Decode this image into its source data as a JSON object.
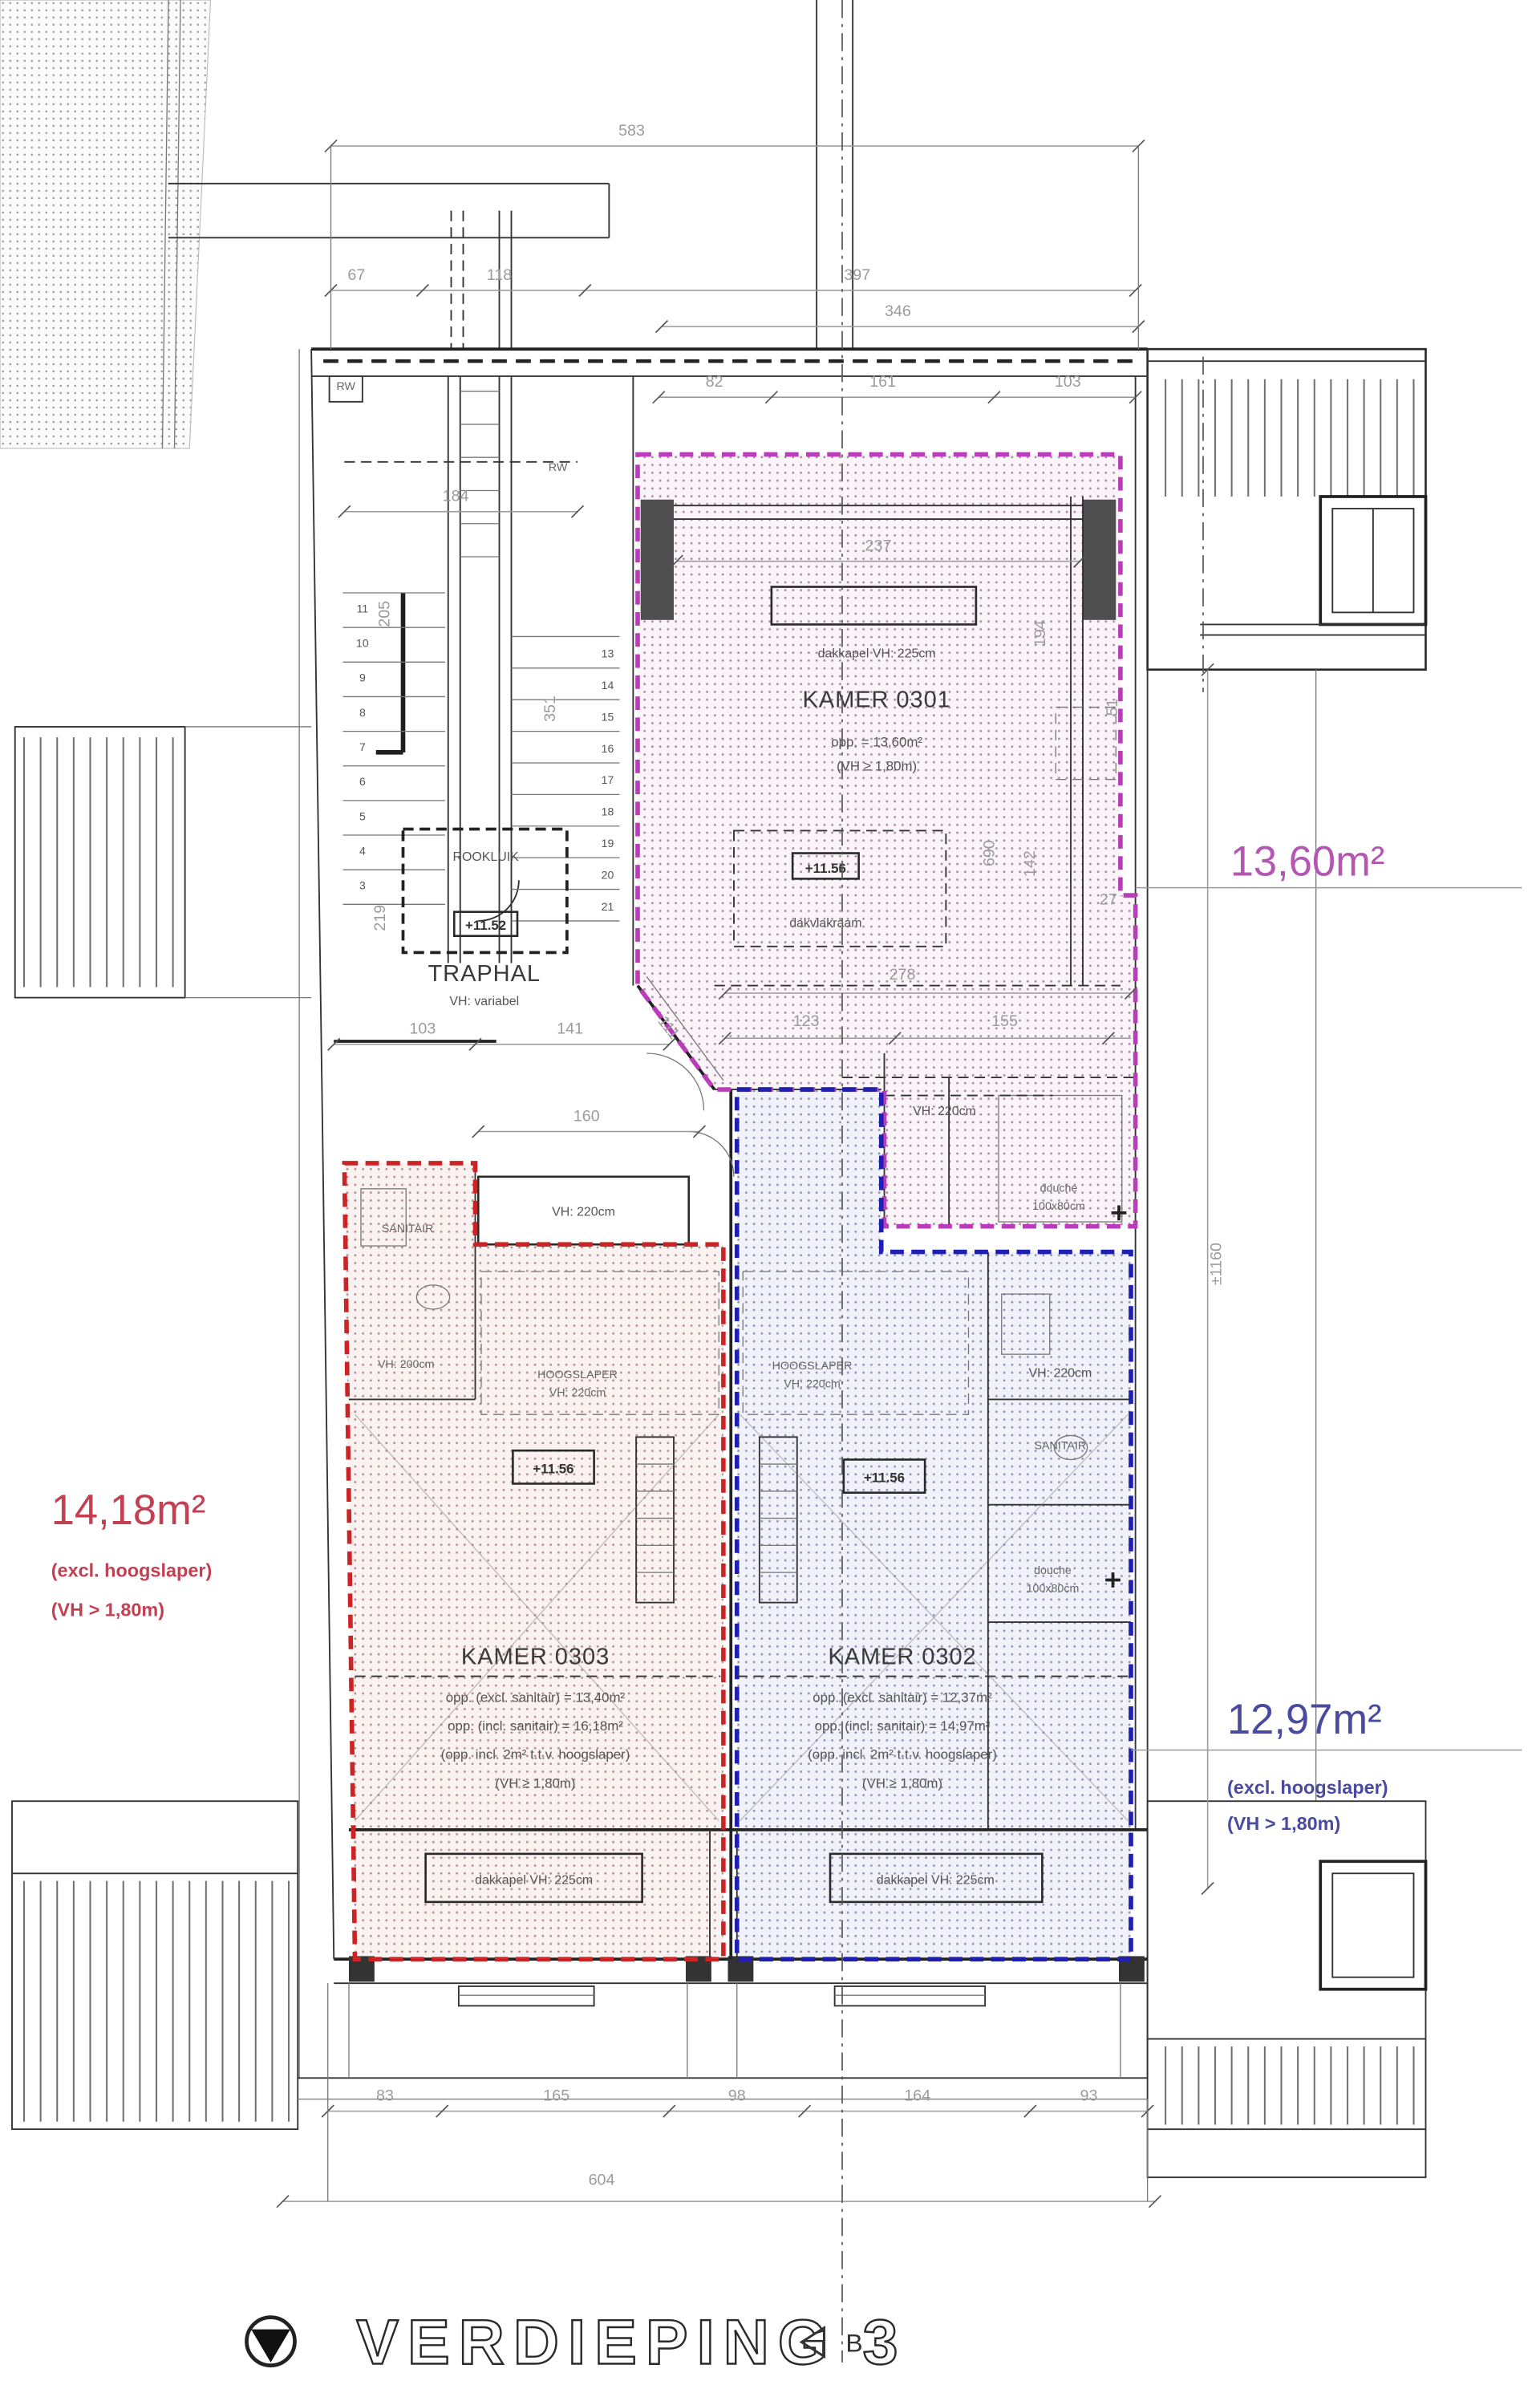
{
  "colors": {
    "magenta": "#b93cb9",
    "red": "#cc2424",
    "blue": "#2020b0",
    "callout_magenta": "#b357b3",
    "callout_red": "#c24052",
    "callout_blue": "#4a4aa0"
  },
  "title": {
    "floor_label": "VERDIEPING 3",
    "section_marker": "B"
  },
  "stairs": {
    "left": [
      "11",
      "10",
      "9",
      "8",
      "7",
      "6",
      "5",
      "4",
      "3"
    ],
    "right": [
      "13",
      "14",
      "15",
      "16",
      "17",
      "18",
      "19",
      "20",
      "21"
    ]
  },
  "traphal": {
    "name": "TRAPHAL",
    "vh": "VH: variabel",
    "rookluik": "ROOKLUIK",
    "level": "+11.52",
    "landing_vh": "VH: 220cm"
  },
  "kamer0301": {
    "name": "KAMER 0301",
    "dakkapel": "dakkapel VH: 225cm",
    "area": "opp. = 13,60m²",
    "vh": "(VH ≥ 1,80m)",
    "level": "+11.56",
    "dakvlakraam": "dakvlakraam",
    "san_vh": "VH: 220cm",
    "douche_line1": "douche",
    "douche_line2": "100x80cm",
    "callout": "13,60m²"
  },
  "kamer0302": {
    "name": "KAMER 0302",
    "area_excl": "opp. (excl. sanitair) = 12,37m²",
    "area_incl": "opp. (incl. sanitair) = 14,97m²",
    "note": "(opp. incl. 2m² t.t.v. hoogslaper)",
    "vh": "(VH ≥ 1,80m)",
    "hoogslaper_line1": "HOOGSLAPER",
    "hoogslaper_line2": "VH: 220cm",
    "level": "+11.56",
    "dakkapel": "dakkapel VH: 225cm",
    "sanitair": "SANITAIR",
    "san_vh": "VH: 220cm",
    "douche_line1": "douche",
    "douche_line2": "100x80cm",
    "callout": "12,97m²",
    "callout_note1": "(excl. hoogslaper)",
    "callout_note2": "(VH > 1,80m)"
  },
  "kamer0303": {
    "name": "KAMER 0303",
    "area_excl": "opp. (excl. sanitair) = 13,40m²",
    "area_incl": "opp. (incl. sanitair) = 16,18m²",
    "note": "(opp. incl. 2m² t.t.v. hoogslaper)",
    "vh": "(VH ≥ 1,80m)",
    "sanitair": "SANITAIR",
    "san_vh": "VH: 200cm",
    "hoogslaper_line1": "HOOGSLAPER",
    "hoogslaper_line2": "VH: 220cm",
    "level": "+11.56",
    "dakkapel": "dakkapel VH: 225cm",
    "callout": "14,18m²",
    "callout_note1": "(excl. hoogslaper)",
    "callout_note2": "(VH > 1,80m)"
  },
  "labels": {
    "rw": "RW"
  },
  "dims": {
    "total_width": "583",
    "w67": "67",
    "w118": "118",
    "w397": "397",
    "w346": "346",
    "w82": "82",
    "w161": "161",
    "w103_top": "103",
    "w184": "184",
    "w237": "237",
    "h205": "205",
    "h351": "351",
    "h194": "194",
    "h51": "51",
    "h690": "690",
    "h142": "142",
    "w27": "27",
    "h219": "219",
    "w103": "103",
    "w141": "141",
    "w111": "111",
    "w160": "160",
    "w278": "278",
    "w123": "123",
    "w155": "155",
    "h1160": "±1160",
    "w83": "83",
    "w165": "165",
    "w98": "98",
    "w164": "164",
    "w93": "93",
    "total_bottom": "604"
  }
}
